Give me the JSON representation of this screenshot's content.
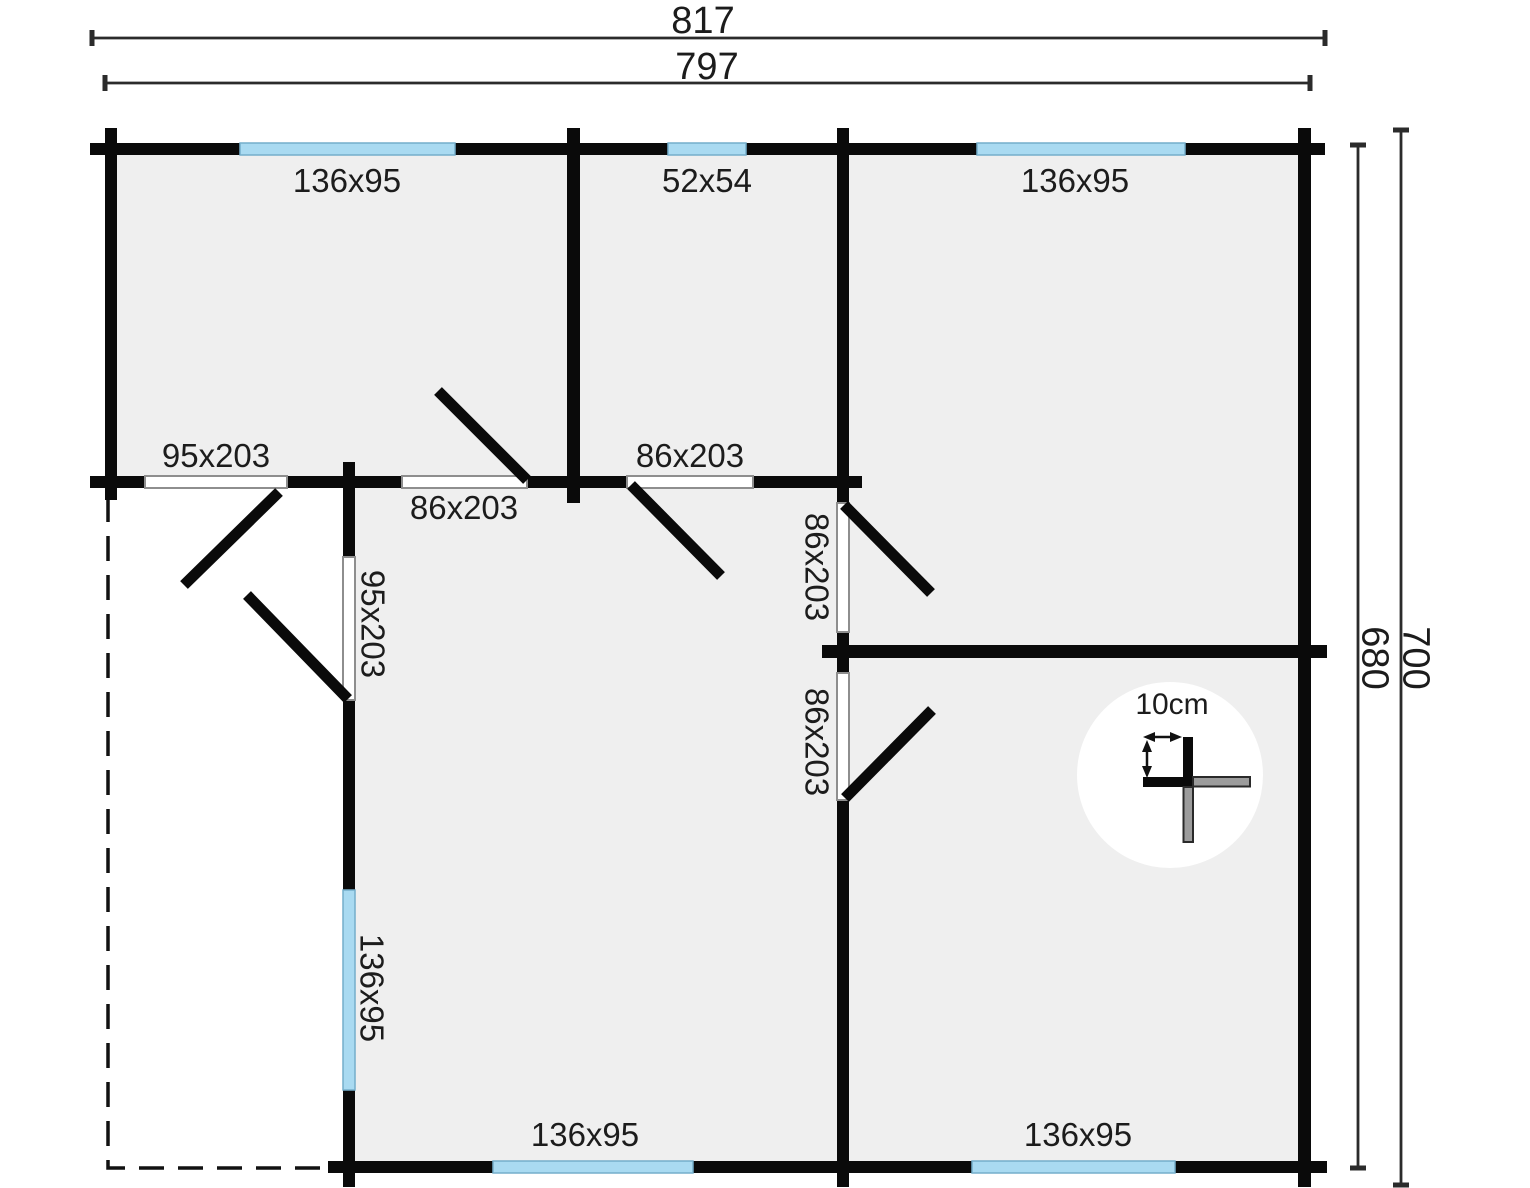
{
  "dimensions": {
    "top_outer": "817",
    "top_inner": "797",
    "right_inner": "680",
    "right_outer": "700"
  },
  "windows": {
    "top_left": "136x95",
    "top_middle": "52x54",
    "top_right": "136x95",
    "left_side": "136x95",
    "bottom_middle": "136x95",
    "bottom_right": "136x95"
  },
  "doors": {
    "front_terrace": "95x203",
    "hall_left": "86x203",
    "hall_right": "86x203",
    "side_terrace": "95x203",
    "right_room_upper": "86x203",
    "right_room_lower": "86x203"
  },
  "scale_indicator": {
    "label": "10cm"
  },
  "colors": {
    "wall": "#0a0a0a",
    "window_fill": "#a9daf1",
    "window_stroke": "#74aecb",
    "room_fill": "#efefef",
    "door_fill": "#ffffff",
    "door_stroke": "#8e8e8e",
    "dim_line": "#2b2b2b",
    "text": "#1c1c1c",
    "scale_gray": "#9c9c9c",
    "page_bg": "#ffffff"
  }
}
